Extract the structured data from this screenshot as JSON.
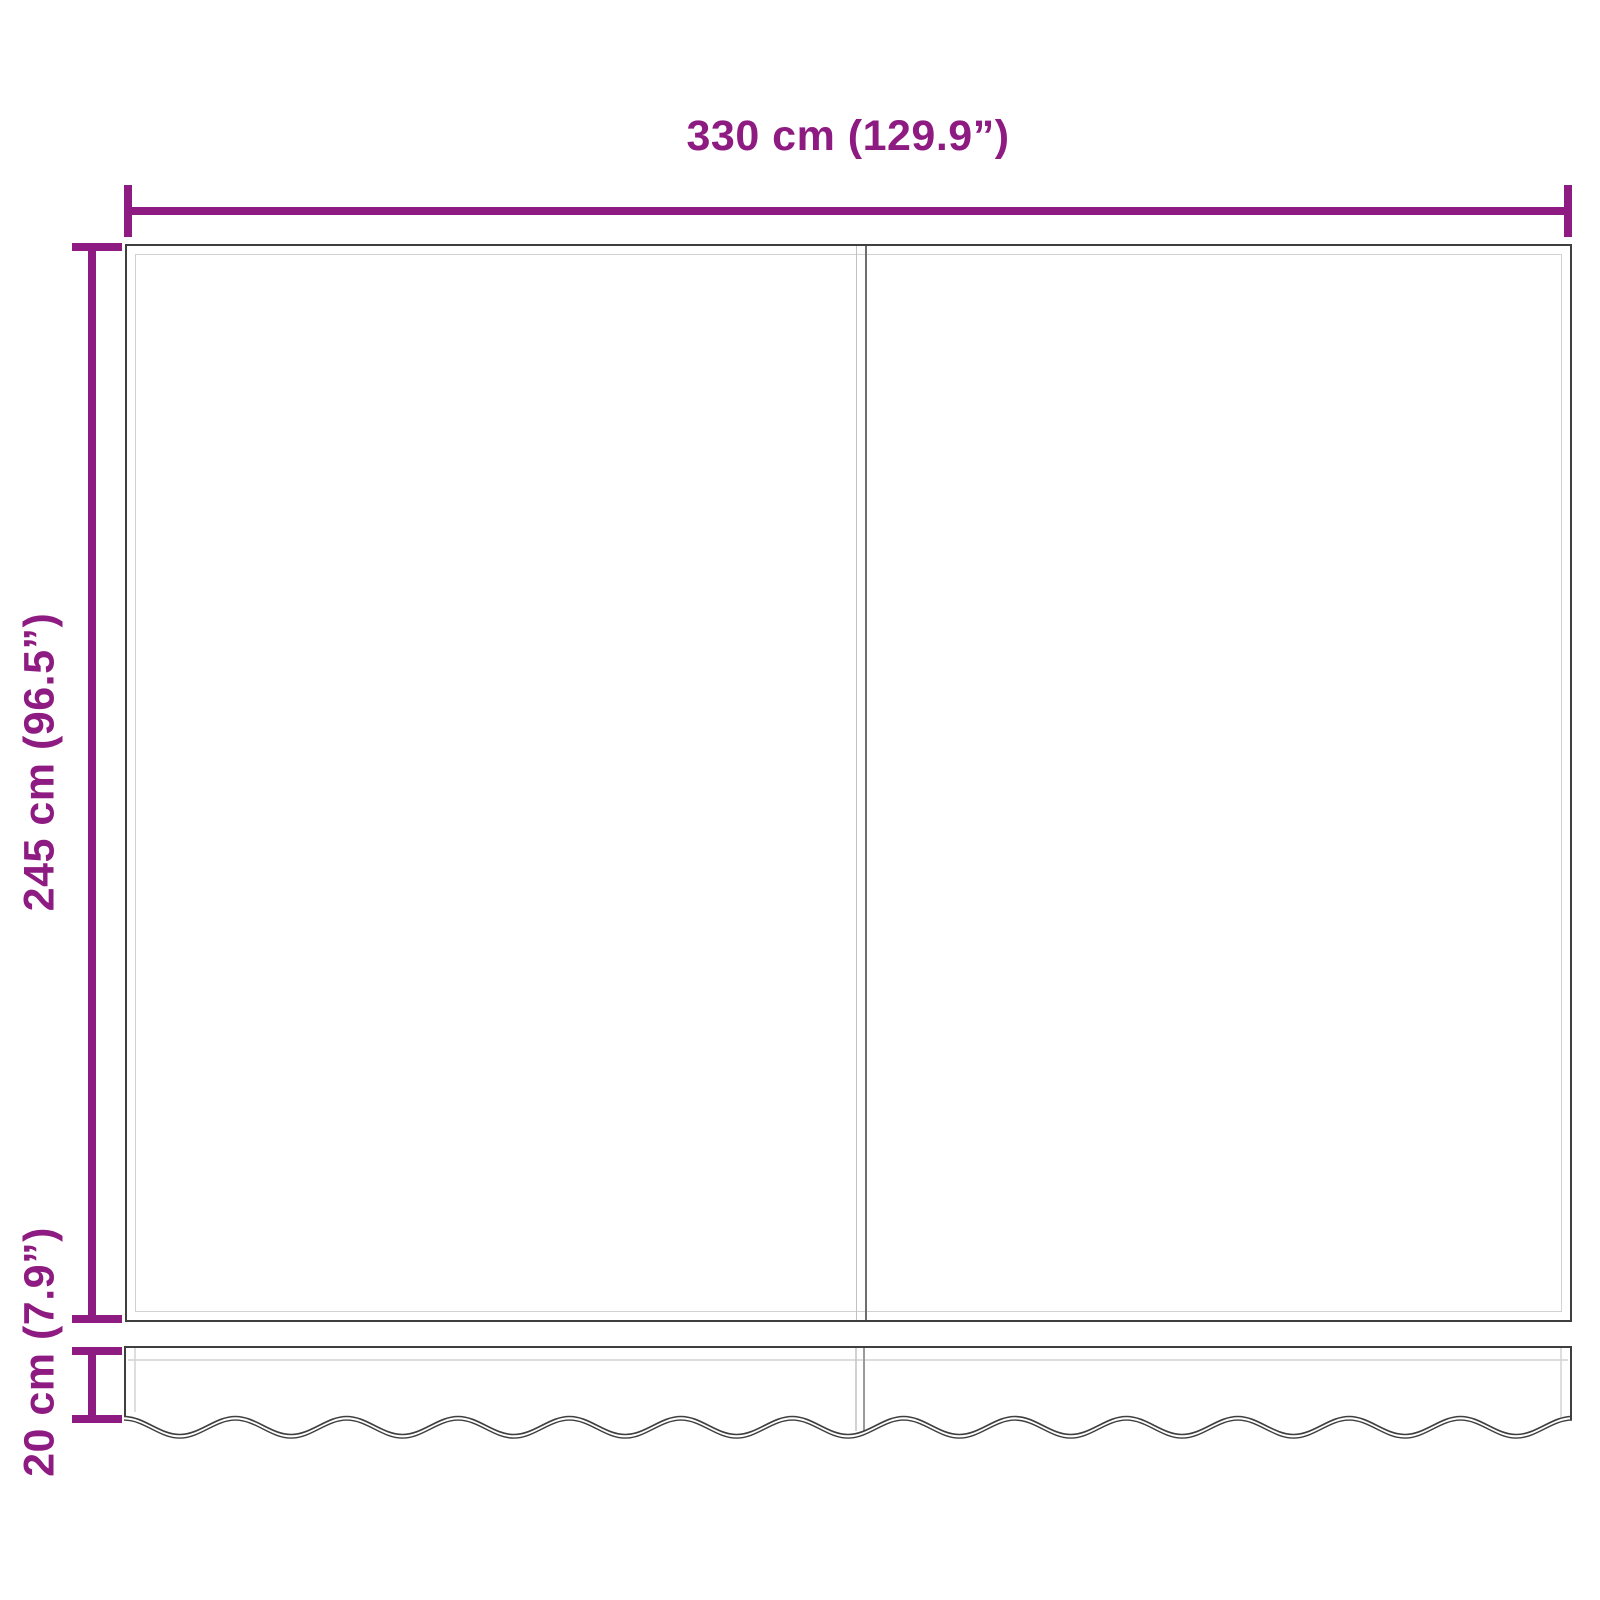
{
  "dimensions": {
    "width": {
      "label": "330 cm (129.9”)",
      "value_cm": 330,
      "value_in": 129.9
    },
    "height": {
      "label": "245 cm (96.5”)",
      "value_cm": 245,
      "value_in": 96.5
    },
    "valance": {
      "label": "20 cm (7.9”)",
      "value_cm": 20,
      "value_in": 7.9
    }
  },
  "colors": {
    "dimension_accent": "#8E1B81",
    "outline_dark": "#3f3f3f",
    "outline_soft": "#6e6e6e",
    "seam_light": "#d2d2d2",
    "background": "#ffffff"
  }
}
